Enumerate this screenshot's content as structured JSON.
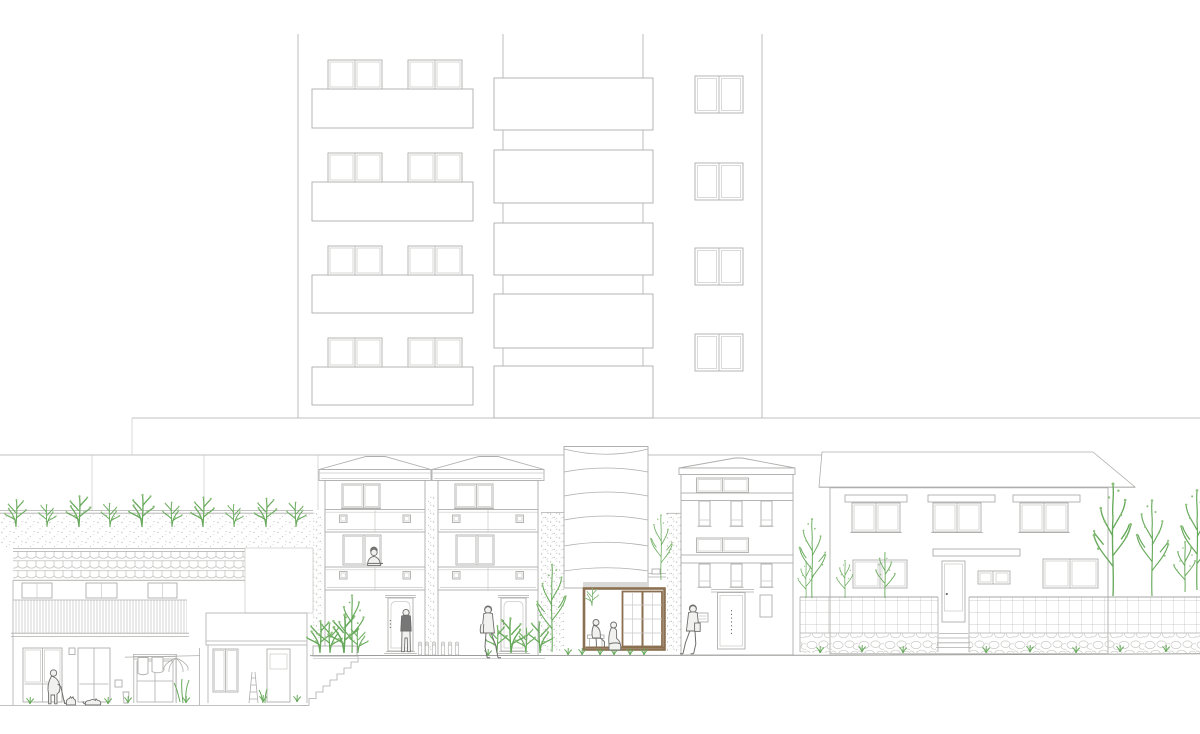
{
  "title": "residential street elevation drawing",
  "colors": {
    "paper": "#ffffff",
    "line": "#aeaeac",
    "line_light": "#c9c9c7",
    "dark": "#6e6e6c",
    "green": "#67a95b",
    "green_light": "#8cc07c",
    "brown": "#8a6f50",
    "shade": "#e8e8e6",
    "band": "#d9d9d7"
  },
  "scene": {
    "tower": {
      "x_left": 298,
      "x_right": 762,
      "y_top": 34,
      "y_bottom": 418,
      "core_lines": [
        503,
        643
      ],
      "balcony_slab_x": [
        312,
        473
      ],
      "balcony_slabs_y": [
        [
          89,
          128
        ],
        [
          182,
          221
        ],
        [
          275,
          313
        ],
        [
          367,
          405
        ]
      ],
      "window_pair_xs": [
        328,
        408
      ],
      "window_pair_w": 54,
      "window_h": 29,
      "core_slab_x": [
        494,
        653
      ],
      "core_slabs_y": [
        [
          78,
          130
        ],
        [
          150,
          203
        ],
        [
          223,
          275
        ],
        [
          294,
          348
        ],
        [
          366,
          418
        ]
      ],
      "right_window_x": 695,
      "right_window_w": 48,
      "right_window_h": 37,
      "right_windows_y": [
        76,
        163,
        248,
        334
      ]
    },
    "datum": {
      "lineA": [
        132,
        418,
        1200,
        418
      ],
      "lineB": [
        0,
        455,
        822,
        455
      ],
      "joints": [
        [
          132,
          418,
          455
        ],
        [
          92,
          455,
          511
        ],
        [
          204,
          455,
          511
        ],
        [
          318,
          455,
          510
        ]
      ]
    },
    "hedge": {
      "x1": 0,
      "x2": 313,
      "top": 510,
      "band_top": 513,
      "band_bottom": 548,
      "shrubs": [
        {
          "x": 16,
          "s": 1.1,
          "f": 1
        },
        {
          "x": 47,
          "s": 0.9,
          "f": -1
        },
        {
          "x": 79,
          "s": 1.25,
          "f": 1
        },
        {
          "x": 110,
          "s": 0.95,
          "f": -1
        },
        {
          "x": 142,
          "s": 1.3,
          "f": 1
        },
        {
          "x": 172,
          "s": 1.0,
          "f": -1
        },
        {
          "x": 203,
          "s": 1.2,
          "f": 1
        },
        {
          "x": 234,
          "s": 0.9,
          "f": -1
        },
        {
          "x": 266,
          "s": 1.15,
          "f": 1
        },
        {
          "x": 296,
          "s": 1.0,
          "f": -1
        }
      ]
    },
    "townhouse_x": [
      322,
      435
    ],
    "bushes": [
      {
        "x": 320,
        "s": 1.3,
        "f": 1
      },
      {
        "x": 330,
        "s": 1.2,
        "f": -1
      },
      {
        "x": 344,
        "s": 1.55,
        "f": 1
      },
      {
        "x": 358,
        "s": 1.0,
        "f": -1
      },
      {
        "x": 497,
        "s": 1.1,
        "f": 1
      },
      {
        "x": 511,
        "s": 1.4,
        "f": -1
      },
      {
        "x": 526,
        "s": 1.0,
        "f": 1
      },
      {
        "x": 540,
        "s": 1.25,
        "f": -1
      }
    ],
    "trees": [
      {
        "t": "sm",
        "x": 352,
        "y": 653,
        "s": 1.15,
        "f": 1
      },
      {
        "t": "tall",
        "x": 552,
        "y": 652,
        "s": 1.05,
        "f": 1
      },
      {
        "t": "tall",
        "x": 661,
        "y": 580,
        "s": 0.78,
        "f": -1
      },
      {
        "t": "sm",
        "x": 806,
        "y": 598,
        "s": 0.72,
        "f": 1
      },
      {
        "t": "tall",
        "x": 812,
        "y": 598,
        "s": 0.95,
        "f": -1
      },
      {
        "t": "sm",
        "x": 845,
        "y": 598,
        "s": 0.75,
        "f": 1
      },
      {
        "t": "sm",
        "x": 885,
        "y": 598,
        "s": 0.9,
        "f": -1
      },
      {
        "t": "tall",
        "x": 1113,
        "y": 596,
        "s": 1.35,
        "f": 1
      },
      {
        "t": "tall",
        "x": 1152,
        "y": 596,
        "s": 1.15,
        "f": -1
      },
      {
        "t": "sm",
        "x": 1185,
        "y": 592,
        "s": 1.0,
        "f": 1
      },
      {
        "t": "tall",
        "x": 1197,
        "y": 590,
        "s": 1.2,
        "f": -1
      }
    ],
    "people": [
      {
        "t": "elderly",
        "x": 54,
        "y": 704
      },
      {
        "t": "lean",
        "x": 374,
        "y": 566
      },
      {
        "t": "door",
        "x": 406,
        "y": 652
      },
      {
        "t": "walk-right",
        "x": 488,
        "y": 658
      },
      {
        "t": "sit-bench",
        "x": 597,
        "y": 647
      },
      {
        "t": "sit-floor",
        "x": 615,
        "y": 651
      },
      {
        "t": "walk-left",
        "x": 693,
        "y": 654
      }
    ],
    "cats": [
      {
        "t": "sit",
        "x": 71,
        "y": 705
      },
      {
        "t": "lie",
        "x": 93,
        "y": 705
      }
    ],
    "meters": [
      420,
      427,
      434,
      443,
      450,
      457
    ],
    "tufts": [
      [
        30,
        704
      ],
      [
        108,
        704
      ],
      [
        128,
        703
      ],
      [
        186,
        703
      ],
      [
        263,
        702
      ],
      [
        297,
        702
      ],
      [
        488,
        656
      ],
      [
        568,
        655
      ],
      [
        582,
        655
      ],
      [
        600,
        655
      ],
      [
        614,
        655
      ],
      [
        630,
        655
      ],
      [
        644,
        655
      ],
      [
        820,
        653
      ],
      [
        862,
        652
      ],
      [
        903,
        653
      ],
      [
        986,
        653
      ],
      [
        1030,
        652
      ],
      [
        1076,
        653
      ],
      [
        1120,
        652
      ],
      [
        1166,
        652
      ]
    ],
    "indoor_plant": {
      "x": 592,
      "y": 606,
      "s": 0.7
    }
  }
}
